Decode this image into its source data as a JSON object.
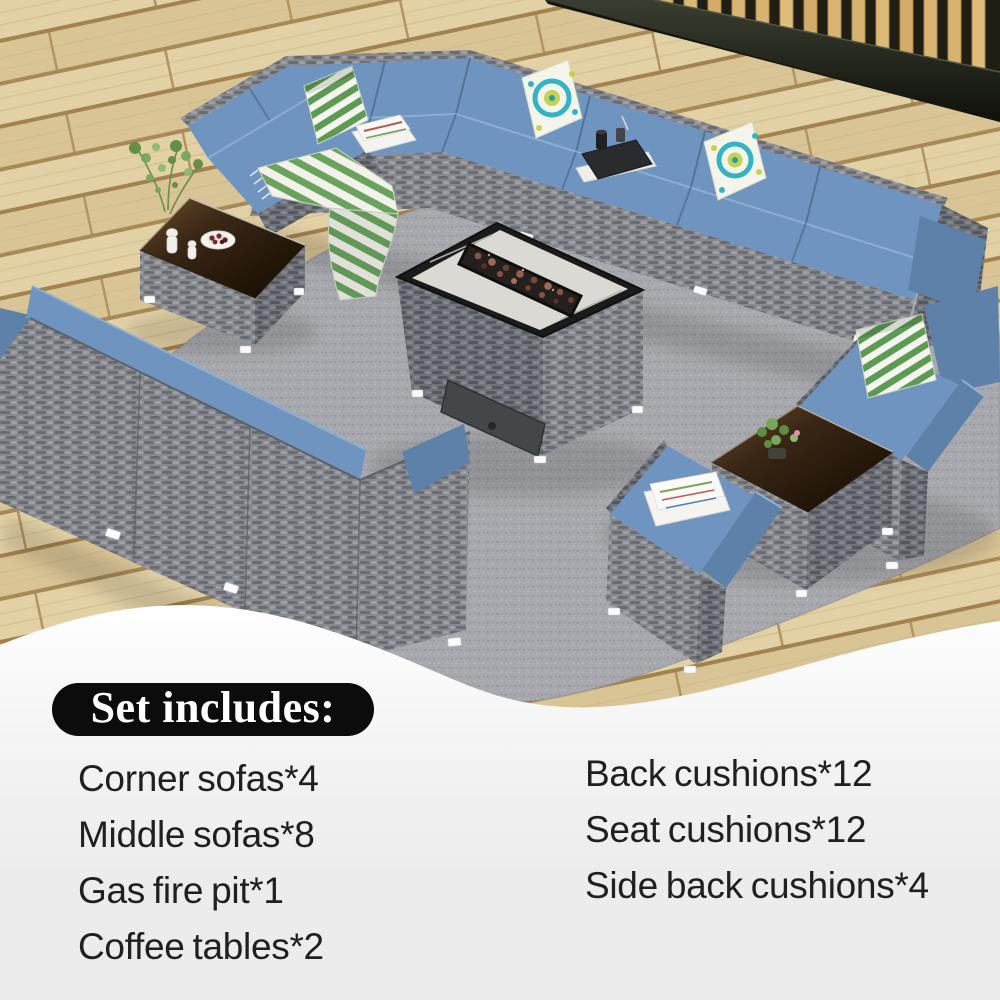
{
  "info": {
    "heading": "Set includes:",
    "left_items": [
      "Corner sofas*4",
      "Middle sofas*8",
      "Gas fire pit*1",
      "Coffee tables*2"
    ],
    "right_items": [
      "Back cushions*12",
      "Seat cushions*12",
      "Side back cushions*4"
    ]
  },
  "colors": {
    "cushion-blue": "#6f94bf",
    "cushion-blue-dark": "#5e81aa",
    "cushion-highlight": "#8db0d6",
    "pill-black": "#0c0c0c",
    "text-dark": "#202020",
    "info-bg": "#ececec",
    "rug-gray": "#a7a8ad",
    "wicker-gray": "#85878d",
    "deck-tan": "#dfcca0",
    "stripe-green": "#5d9a54",
    "paisley-teal": "#35b3c4",
    "paisley-lime": "#c5d24f",
    "lava-brown": "#8a5142",
    "glass-brown": "#4a3319"
  }
}
